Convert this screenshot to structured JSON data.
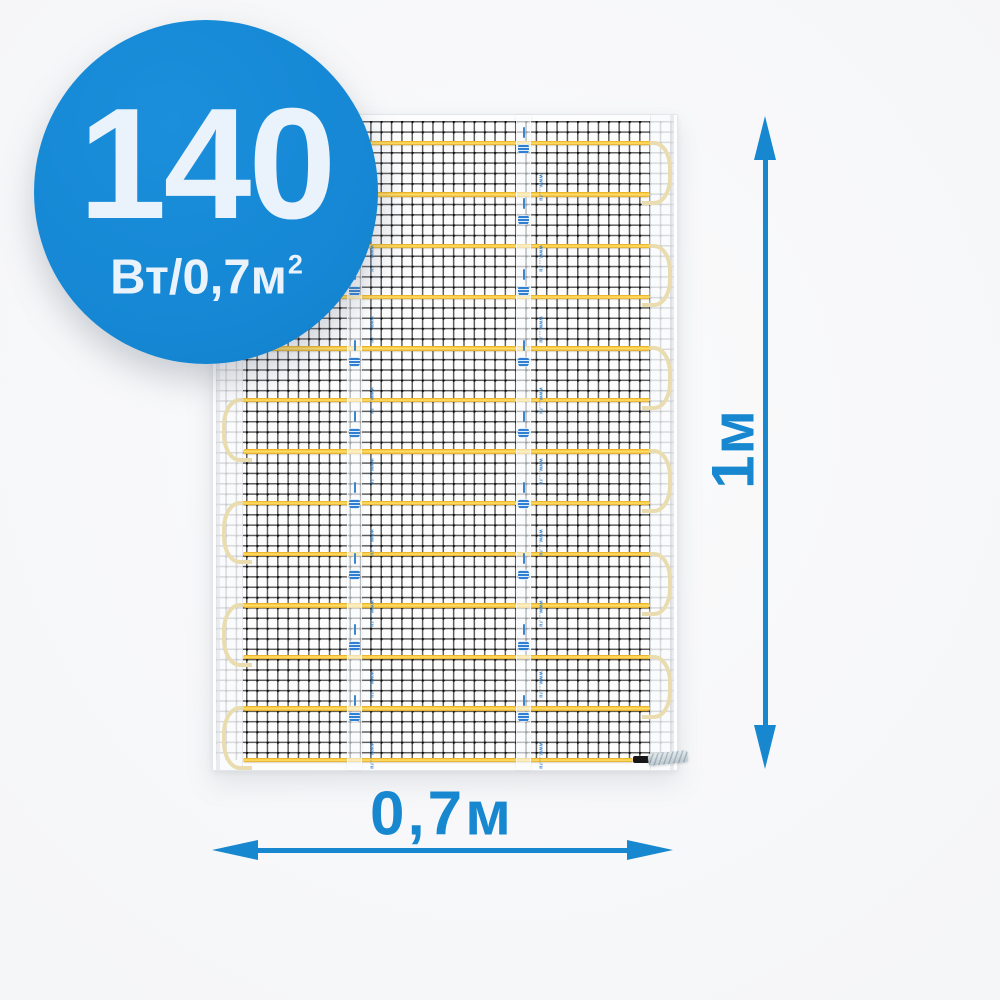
{
  "product_badge": {
    "value": "140",
    "unit": "Вт/0,7м",
    "unit_superscript": "2",
    "bg_color": "#1587d4",
    "text_color": "#eaf2fb"
  },
  "dimension_annotations": {
    "vertical_label": "1м",
    "horizontal_label": "0,7м",
    "arrow_color": "#1788d0"
  },
  "heating_mat": {
    "cable_rows": 13,
    "cable_color": "#ffd24a",
    "cable_edge_color": "#e2a81f",
    "cable_loop_color": "#e9dcae",
    "mesh_line_color": "#1e1e1e",
    "tape_strip_count": 2,
    "tape_logo_color": "#2f7fd2",
    "tape_micro_text": "www.....ru",
    "cold_lead_sleeve_color": "#161616",
    "cold_lead_splice_color": "#c1ccd2"
  }
}
